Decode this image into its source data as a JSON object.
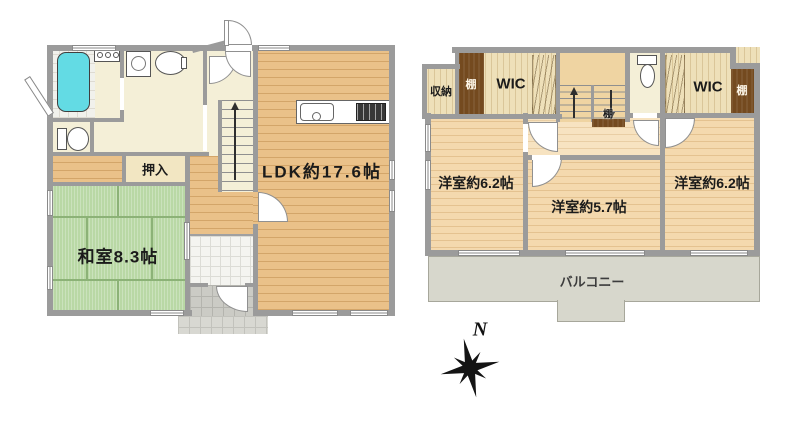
{
  "palette": {
    "wall": "#9b9b9b",
    "tatami_green": "#b9d8a5",
    "wood_floor_1f": "#eac189",
    "wood_floor_2f": "#f4d9ae",
    "cream_floor": "#f4efd7",
    "balcony_gray": "#d7d7cc",
    "shelf_brown": "#744a1f",
    "bathtub_cyan": "#63dbe4"
  },
  "icons": {
    "compass_rose": "8-point-star",
    "stairs_up_arrow": "↑",
    "stairs_down_arrow": "↓"
  },
  "floor1": {
    "oshiire": "押入",
    "washitsu": "和室8.3帖",
    "ldk": "LDK約17.6帖"
  },
  "floor2": {
    "shuno": "収納",
    "shelf_left": "棚",
    "wic_left": "WIC",
    "shelf_stairs": "棚",
    "wic_right": "WIC",
    "shelf_right": "棚",
    "bedroom_left": "洋室約6.2帖",
    "bedroom_middle": "洋室約5.7帖",
    "bedroom_right": "洋室約6.2帖",
    "balcony": "バルコニー"
  },
  "compass": {
    "north": "N"
  }
}
